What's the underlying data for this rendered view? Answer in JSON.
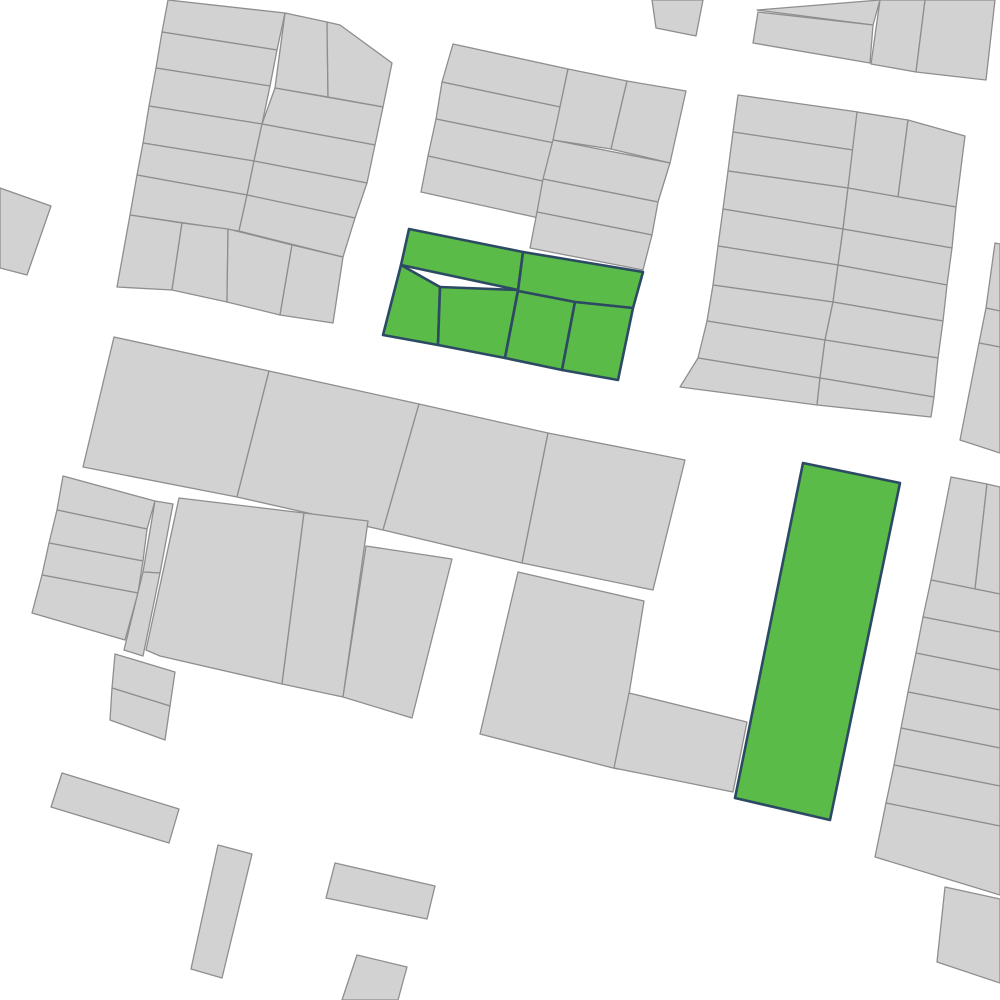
{
  "map": {
    "background_color": "#ffffff",
    "parcel_fill": "#d2d2d2",
    "parcel_stroke": "#8e8e8e",
    "highlight_fill": "#5abb48",
    "highlight_stroke": "#2c4a63",
    "highlighted_groups": 2,
    "parcels": [
      {
        "id": "a1",
        "type": "normal",
        "points": "168,0 285,13 277,50 162,32"
      },
      {
        "id": "a2",
        "type": "normal",
        "points": "162,32 277,50 270,86 156,68"
      },
      {
        "id": "a3",
        "type": "normal",
        "points": "156,68 270,86 262,124 149,106"
      },
      {
        "id": "a4",
        "type": "normal",
        "points": "149,106 262,124 254,161 143,143"
      },
      {
        "id": "a5",
        "type": "normal",
        "points": "143,143 254,161 247,195 137,175"
      },
      {
        "id": "a6",
        "type": "normal",
        "points": "137,175 247,195 239,231 130,215"
      },
      {
        "id": "a7",
        "type": "normal",
        "points": "130,215 182,223 172,290 117,287"
      },
      {
        "id": "a8",
        "type": "normal",
        "points": "182,223 228,229 227,302 172,290"
      },
      {
        "id": "a9",
        "type": "normal",
        "points": "228,229 292,245 280,315 227,302"
      },
      {
        "id": "a10",
        "type": "normal",
        "points": "292,245 343,257 333,323 280,315"
      },
      {
        "id": "a11",
        "type": "normal",
        "points": "285,13 327,22 328,97 275,88"
      },
      {
        "id": "a12",
        "type": "normal",
        "points": "327,22 340,25 392,63 383,107 328,97"
      },
      {
        "id": "a13",
        "type": "normal",
        "points": "275,88 383,107 375,145 262,124"
      },
      {
        "id": "a14",
        "type": "normal",
        "points": "262,124 375,145 367,183 254,161"
      },
      {
        "id": "a15",
        "type": "normal",
        "points": "254,161 367,183 355,218 247,195"
      },
      {
        "id": "a16",
        "type": "normal",
        "points": "247,195 355,218 343,257 239,231"
      },
      {
        "id": "l1",
        "type": "normal",
        "points": "0,188 51,206 27,275 0,268"
      },
      {
        "id": "w1",
        "type": "normal",
        "points": "652,0 703,0 696,36 656,28"
      },
      {
        "id": "b1",
        "type": "normal",
        "points": "453,44 568,69 560,107 442,82"
      },
      {
        "id": "b2",
        "type": "normal",
        "points": "442,82 560,107 554,143 436,119"
      },
      {
        "id": "b3",
        "type": "normal",
        "points": "436,119 554,143 547,182 428,156"
      },
      {
        "id": "b4",
        "type": "normal",
        "points": "428,156 547,182 539,218 421,192"
      },
      {
        "id": "b5",
        "type": "normal",
        "points": "568,69 627,81 611,149 553,140"
      },
      {
        "id": "b6",
        "type": "normal",
        "points": "627,81 686,91 670,163 611,149"
      },
      {
        "id": "b7",
        "type": "normal",
        "points": "553,140 670,163 658,202 543,179"
      },
      {
        "id": "b8",
        "type": "normal",
        "points": "543,179 658,202 652,235 537,212"
      },
      {
        "id": "b9",
        "type": "normal",
        "points": "537,212 652,235 643,270 530,248"
      },
      {
        "id": "t1",
        "type": "normal",
        "points": "757,10 880,0 873,25"
      },
      {
        "id": "t2",
        "type": "normal",
        "points": "758,12 873,25 870,63 753,43"
      },
      {
        "id": "t3",
        "type": "normal",
        "points": "880,0 925,0 916,72 871,64"
      },
      {
        "id": "t4",
        "type": "normal",
        "points": "925,0 995,0 986,80 916,72"
      },
      {
        "id": "h1",
        "type": "normal",
        "points": "738,95 858,112 853,150 733,132"
      },
      {
        "id": "h2",
        "type": "normal",
        "points": "733,132 853,150 848,188 728,171"
      },
      {
        "id": "h3",
        "type": "normal",
        "points": "728,171 848,188 843,229 723,209"
      },
      {
        "id": "h4",
        "type": "normal",
        "points": "723,209 843,229 838,265 718,246"
      },
      {
        "id": "h5",
        "type": "normal",
        "points": "718,246 838,265 833,302 713,285"
      },
      {
        "id": "h6",
        "type": "normal",
        "points": "713,285 833,302 825,340 707,321"
      },
      {
        "id": "h7",
        "type": "normal",
        "points": "707,321 825,340 820,378 698,358"
      },
      {
        "id": "h8",
        "type": "normal",
        "points": "698,358 820,378 817,405 680,387"
      },
      {
        "id": "h9",
        "type": "normal",
        "points": "857,112 908,120 898,197 848,188"
      },
      {
        "id": "h10",
        "type": "normal",
        "points": "908,120 965,136 956,207 898,197"
      },
      {
        "id": "h11",
        "type": "normal",
        "points": "848,188 956,207 952,248 843,229"
      },
      {
        "id": "h12",
        "type": "normal",
        "points": "843,229 952,248 947,285 838,265"
      },
      {
        "id": "h13",
        "type": "normal",
        "points": "838,265 947,285 943,321 833,302"
      },
      {
        "id": "h14",
        "type": "normal",
        "points": "833,302 943,321 938,358 825,340"
      },
      {
        "id": "h15",
        "type": "normal",
        "points": "825,340 938,358 934,397 820,378"
      },
      {
        "id": "h16",
        "type": "normal",
        "points": "820,378 934,397 931,417 817,405"
      },
      {
        "id": "k1",
        "type": "normal",
        "points": "995,243 1000,244 1000,311 986,308"
      },
      {
        "id": "k2",
        "type": "normal",
        "points": "986,308 1000,311 1000,347 979,343"
      },
      {
        "id": "k3",
        "type": "normal",
        "points": "979,343 1000,347 1000,453 960,440"
      },
      {
        "id": "c1",
        "type": "normal",
        "points": "114,337 269,371 237,497 83,467"
      },
      {
        "id": "c2",
        "type": "normal",
        "points": "269,371 419,404 383,530 237,497"
      },
      {
        "id": "c3",
        "type": "normal",
        "points": "419,404 548,433 522,563 383,530"
      },
      {
        "id": "c4",
        "type": "normal",
        "points": "548,433 685,460 653,590 522,563"
      },
      {
        "id": "d1",
        "type": "normal",
        "points": "179,498 304,513 282,684 160,656 146,650"
      },
      {
        "id": "d2",
        "type": "normal",
        "points": "304,513 368,521 343,697 282,684"
      },
      {
        "id": "d3",
        "type": "normal",
        "points": "366,546 452,559 412,718 343,697"
      },
      {
        "id": "e1",
        "type": "normal",
        "points": "63,476 155,501 147,529 57,510"
      },
      {
        "id": "e2",
        "type": "normal",
        "points": "57,510 147,529 143,561 49,543"
      },
      {
        "id": "e3",
        "type": "normal",
        "points": "49,543 143,561 138,593 42,575"
      },
      {
        "id": "e4",
        "type": "normal",
        "points": "42,575 138,593 125,640 32,613"
      },
      {
        "id": "e5",
        "type": "normal",
        "points": "155,501 173,504 160,573 143,572"
      },
      {
        "id": "e6",
        "type": "normal",
        "points": "143,572 160,573 143,656 124,650"
      },
      {
        "id": "g1",
        "type": "normal",
        "points": "115,654 175,672 170,706 112,688"
      },
      {
        "id": "g2",
        "type": "normal",
        "points": "112,688 170,706 165,740 110,720"
      },
      {
        "id": "f1",
        "type": "normal",
        "points": "518,572 644,601 617,769 480,734"
      },
      {
        "id": "f2",
        "type": "normal",
        "points": "629,693 747,722 733,792 614,768"
      },
      {
        "id": "i1",
        "type": "normal",
        "points": "951,477 987,484 975,589 931,580"
      },
      {
        "id": "i2",
        "type": "normal",
        "points": "987,484 1000,487 1000,594 975,589"
      },
      {
        "id": "i3",
        "type": "normal",
        "points": "931,580 1000,594 1000,632 923,617"
      },
      {
        "id": "i4",
        "type": "normal",
        "points": "923,617 1000,632 1000,670 916,653"
      },
      {
        "id": "i5",
        "type": "normal",
        "points": "916,653 1000,670 1000,710 908,692"
      },
      {
        "id": "i6",
        "type": "normal",
        "points": "908,692 1000,710 1000,748 901,728"
      },
      {
        "id": "i7",
        "type": "normal",
        "points": "901,728 1000,748 1000,786 894,765"
      },
      {
        "id": "i8",
        "type": "normal",
        "points": "894,765 1000,786 1000,826 886,803"
      },
      {
        "id": "i9",
        "type": "normal",
        "points": "886,803 1000,826 1000,895 875,857"
      },
      {
        "id": "j1",
        "type": "normal",
        "points": "945,887 1000,899 1000,983 937,962"
      },
      {
        "id": "r1",
        "type": "normal",
        "points": "62,773 179,809 169,843 51,807"
      },
      {
        "id": "r2",
        "type": "normal",
        "points": "218,845 252,854 222,978 191,969"
      },
      {
        "id": "r3",
        "type": "normal",
        "points": "335,863 435,886 427,919 326,898"
      },
      {
        "id": "r4",
        "type": "normal",
        "points": "357,955 407,967 398,1000 342,1000"
      },
      {
        "id": "sel1",
        "type": "highlight",
        "points": "409,229 523,252 518,290 401,265"
      },
      {
        "id": "sel2",
        "type": "highlight",
        "points": "523,252 643,272 633,308 575,302 518,291"
      },
      {
        "id": "sel3",
        "type": "highlight",
        "points": "401,265 440,287 438,345 383,335"
      },
      {
        "id": "sel4",
        "type": "highlight",
        "points": "440,287 518,290 505,358 438,345"
      },
      {
        "id": "sel5",
        "type": "highlight",
        "points": "518,291 575,302 562,370 505,358"
      },
      {
        "id": "sel6",
        "type": "highlight",
        "points": "575,302 633,308 618,380 562,370"
      },
      {
        "id": "sel7",
        "type": "highlight",
        "points": "803,463 900,483 830,820 735,798"
      }
    ]
  }
}
